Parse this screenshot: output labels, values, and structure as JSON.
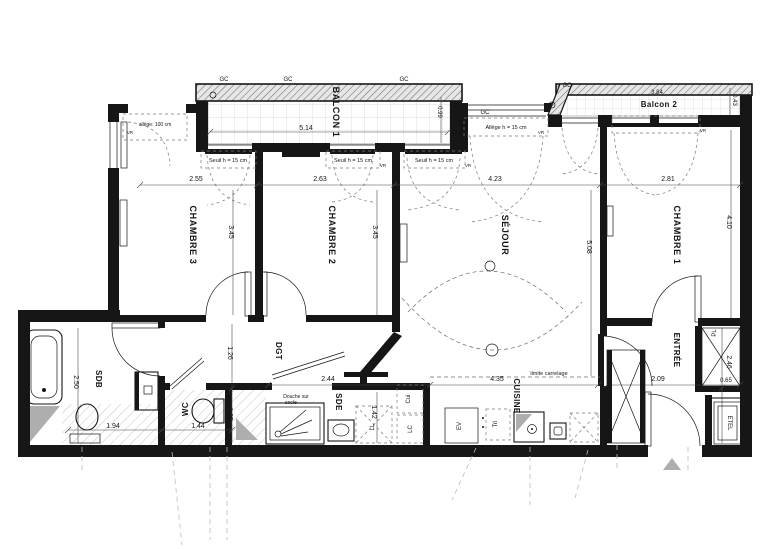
{
  "plan": {
    "rooms": {
      "balcon1": "BALCON 1",
      "balcon2": "Balcon 2",
      "chambre1": "CHAMBRE 1",
      "chambre2": "CHAMBRE 2",
      "chambre3": "CHAMBRE 3",
      "sejour": "SÉJOUR",
      "cuisine": "CUISINE",
      "entree": "ENTRÉE",
      "sdb": "SDB",
      "sde": "SDE",
      "wc": "WC",
      "dgt": "DGT"
    },
    "dims": {
      "balcon1_w": "5.14",
      "balcon1_d": "0.99",
      "balcon2_w": "3.84",
      "balcon2_d": "0.43",
      "ch3_w": "2.55",
      "ch3_h": "3.45",
      "ch2_w": "2.63",
      "ch2_h": "3.45",
      "sejour_w": "4.23",
      "sejour_h": "5.08",
      "ch1_w": "2.81",
      "ch1_h": "4.10",
      "sdb_w": "1.94",
      "sdb_h": "2.50",
      "wc_w": "1.44",
      "wc_d": "1.35",
      "dgt_w": "2.44",
      "dgt_h": "1.26",
      "sde_d": "1.42",
      "cuisine_w": "4.35",
      "entree_w": "2.09",
      "entree_h": "2.46",
      "etel_w": "0.65"
    },
    "annotations": {
      "gc": "GC",
      "seuil": "Seuil h = 15 cm",
      "allege15": "Allège h = 15 cm",
      "allege100": "allège: 100 cm",
      "vr": "VR",
      "limite": "limite carrelage",
      "douche1": "Douche sur",
      "douche2": "socle"
    },
    "fixtures": {
      "ll": "LL",
      "lc": "LC",
      "cui": "Cui",
      "ev": "EV",
      "tri": "Tri",
      "pl": "PL",
      "etel": "ETEL"
    }
  }
}
